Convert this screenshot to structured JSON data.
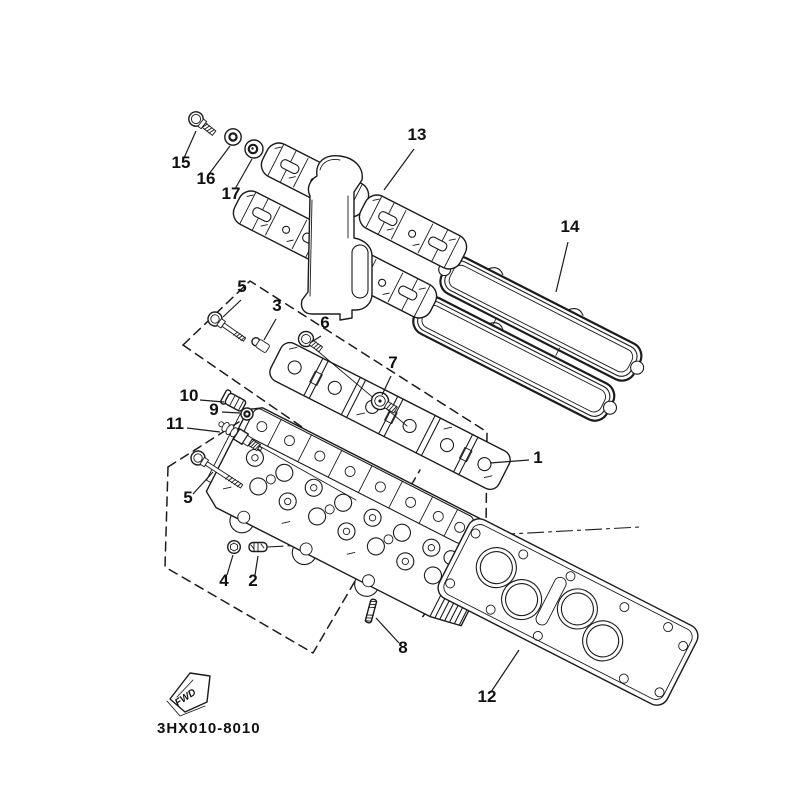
{
  "diagram": {
    "drawing_number": "3HX010-8010",
    "fwd_label": "FWD",
    "colors": {
      "ink": "#1b1b1b",
      "background": "#ffffff"
    },
    "callouts": [
      {
        "label": "1",
        "tx": 538,
        "ty": 463,
        "x1": 529,
        "y1": 460,
        "x2": 490,
        "y2": 463
      },
      {
        "label": "2",
        "tx": 253,
        "ty": 586,
        "x1": 255,
        "y1": 575,
        "x2": 258,
        "y2": 556
      },
      {
        "label": "3",
        "tx": 277,
        "ty": 311,
        "x1": 276,
        "y1": 319,
        "x2": 264,
        "y2": 340
      },
      {
        "label": "4",
        "tx": 224,
        "ty": 586,
        "x1": 227,
        "y1": 575,
        "x2": 233,
        "y2": 555
      },
      {
        "label": "5",
        "tx": 242,
        "ty": 292,
        "x1": 241,
        "y1": 300,
        "x2": 223,
        "y2": 317
      },
      {
        "label": "5",
        "tx": 188,
        "ty": 503,
        "x1": 193,
        "y1": 494,
        "x2": 213,
        "y2": 472
      },
      {
        "label": "6",
        "tx": 325,
        "ty": 328,
        "x1": 321,
        "y1": 336,
        "x2": 310,
        "y2": 343
      },
      {
        "label": "7",
        "tx": 393,
        "ty": 368,
        "x1": 391,
        "y1": 376,
        "x2": 382,
        "y2": 395
      },
      {
        "label": "8",
        "tx": 403,
        "ty": 653,
        "x1": 399,
        "y1": 643,
        "x2": 376,
        "y2": 618
      },
      {
        "label": "9",
        "tx": 214,
        "ty": 415,
        "x1": 222,
        "y1": 412,
        "x2": 240,
        "y2": 413
      },
      {
        "label": "10",
        "tx": 189,
        "ty": 401,
        "x1": 200,
        "y1": 400,
        "x2": 224,
        "y2": 402
      },
      {
        "label": "11",
        "tx": 175,
        "ty": 429,
        "x1": 187,
        "y1": 428,
        "x2": 220,
        "y2": 432
      },
      {
        "label": "12",
        "tx": 487,
        "ty": 702,
        "x1": 491,
        "y1": 692,
        "x2": 519,
        "y2": 650
      },
      {
        "label": "13",
        "tx": 417,
        "ty": 140,
        "x1": 414,
        "y1": 149,
        "x2": 384,
        "y2": 190
      },
      {
        "label": "14",
        "tx": 570,
        "ty": 232,
        "x1": 568,
        "y1": 242,
        "x2": 556,
        "y2": 292
      },
      {
        "label": "15",
        "tx": 181,
        "ty": 168,
        "x1": 184,
        "y1": 158,
        "x2": 196,
        "y2": 131
      },
      {
        "label": "16",
        "tx": 206,
        "ty": 184,
        "x1": 209,
        "y1": 174,
        "x2": 230,
        "y2": 146
      },
      {
        "label": "17",
        "tx": 231,
        "ty": 199,
        "x1": 235,
        "y1": 189,
        "x2": 252,
        "y2": 159
      }
    ]
  }
}
